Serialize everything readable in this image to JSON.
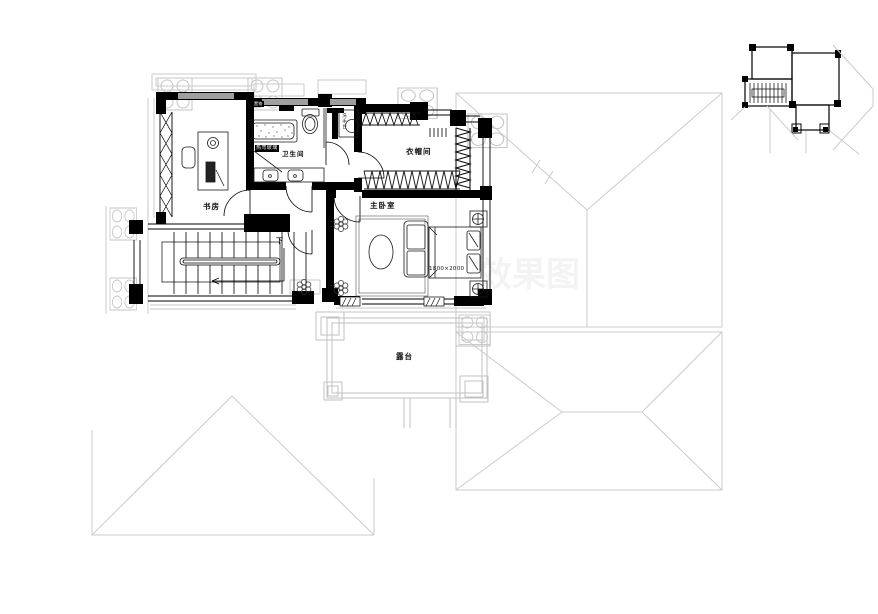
{
  "labels": {
    "study": "书房",
    "bathroom": "卫生间",
    "closet": "衣帽间",
    "bedroom": "主卧室",
    "terrace": "露台",
    "down": "下",
    "bed_size": "1800×2000",
    "glass_chip": "热弯玻璃",
    "shelf_chip": "置物",
    "basin_vertical": "洗手台",
    "watermark": "效果图"
  },
  "colors": {
    "line": "#000000",
    "light_line": "#c9c9c9",
    "background": "#ffffff"
  }
}
